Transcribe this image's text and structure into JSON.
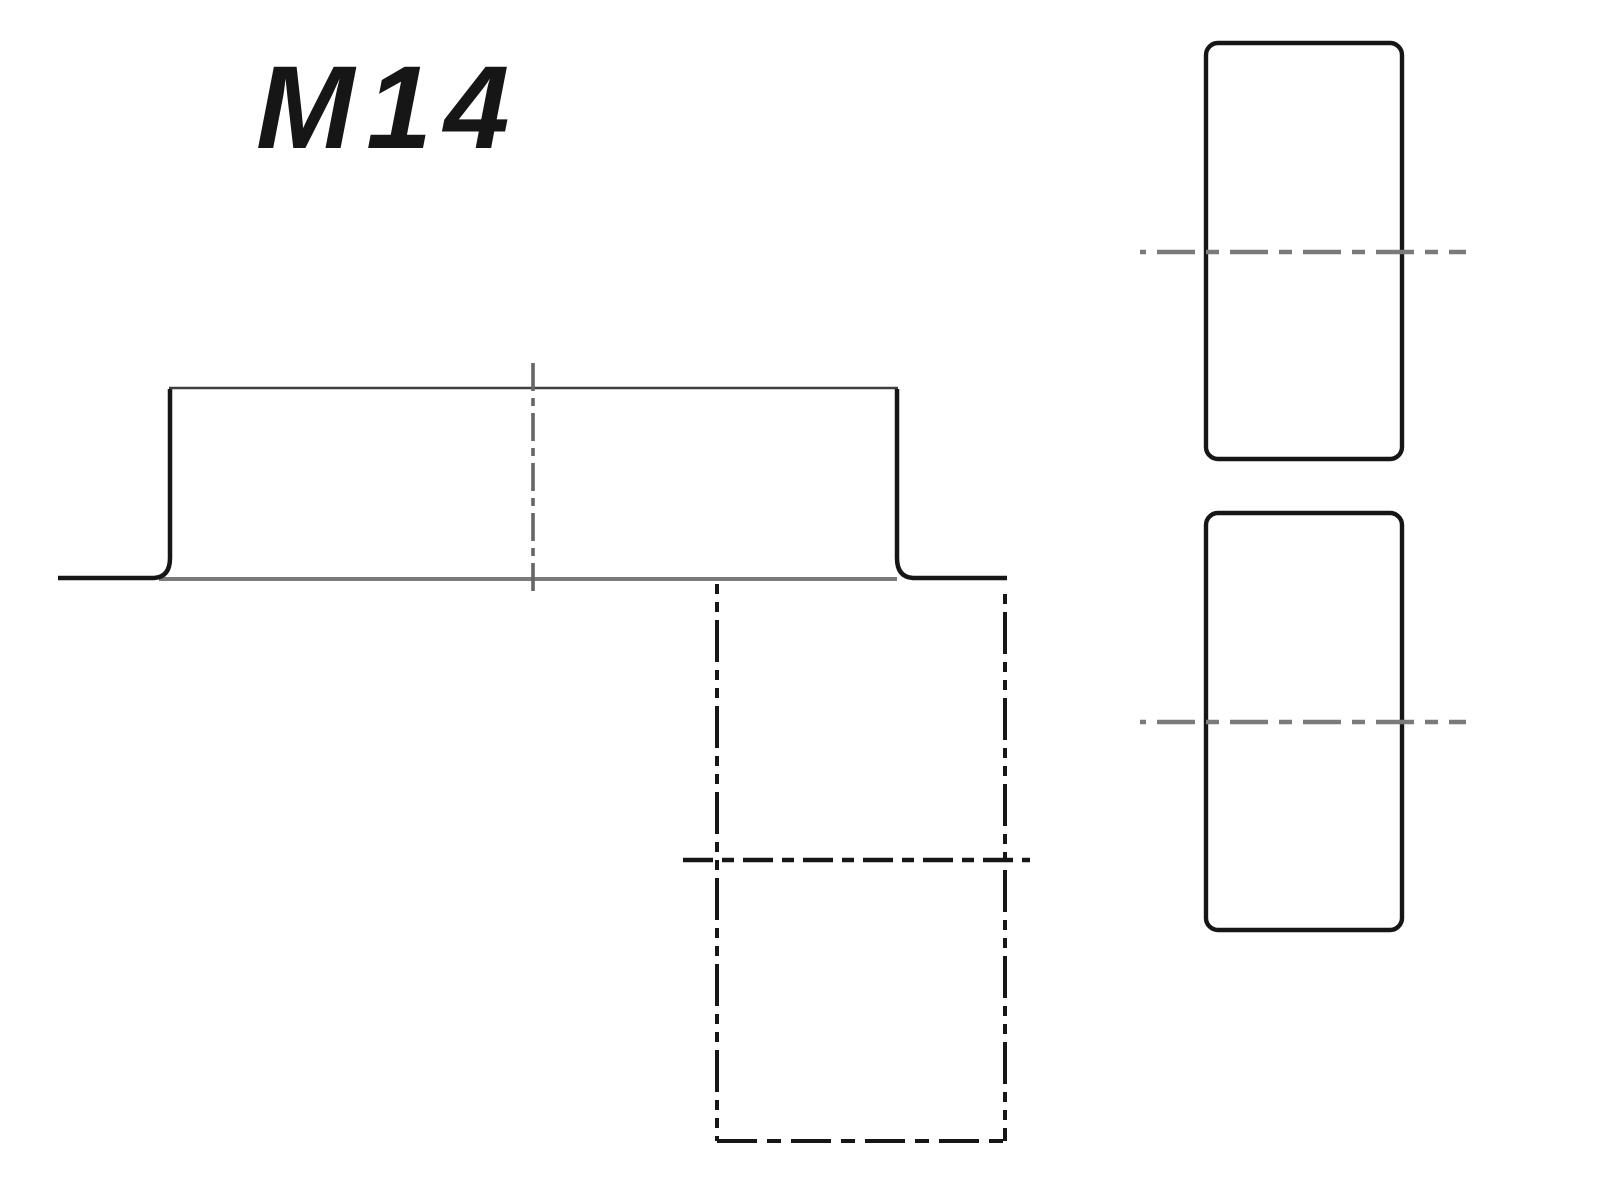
{
  "title": {
    "text": "M14"
  },
  "colors": {
    "background": "#ffffff",
    "text": "#161616",
    "black": "#161616",
    "dark": "#3f3f3f",
    "gray": "#7a7a7a",
    "gray_dark": "#666666"
  },
  "drawing": {
    "canvas": {
      "width": 1597,
      "height": 1200
    },
    "label": {
      "x": 256,
      "y": 148,
      "font_size": 118,
      "letter_spacing": 12
    },
    "elements": [
      {
        "name": "flange-baseline",
        "kind": "line",
        "x1": 159,
        "y1": 579,
        "x2": 897,
        "y2": 579,
        "color": "gray",
        "width": 4,
        "dash": "",
        "offset": 0
      },
      {
        "name": "flange-profile-left-edge",
        "kind": "path",
        "d": "M 58 578 L 154 578 Q 170 577 170 558 L 170 389",
        "color": "black",
        "width": 4.5,
        "dash": "",
        "offset": 0
      },
      {
        "name": "boss-top-edge",
        "kind": "line",
        "x1": 169,
        "y1": 388,
        "x2": 898,
        "y2": 388,
        "color": "dark",
        "width": 2.6,
        "dash": "",
        "offset": 0
      },
      {
        "name": "flange-profile-right-edge",
        "kind": "path",
        "d": "M 897 389 L 897 558 Q 897 577 913 578 L 1007 578",
        "color": "black",
        "width": 4.5,
        "dash": "",
        "offset": 0
      },
      {
        "name": "section-vertical-center-line",
        "kind": "line",
        "x1": 533,
        "y1": 363,
        "x2": 533,
        "y2": 596,
        "color": "gray_dark",
        "width": 3.6,
        "dash": "28 7 8 7",
        "offset": 0
      },
      {
        "name": "hidden-bore-left-edge",
        "kind": "line",
        "x1": 717,
        "y1": 584,
        "x2": 717,
        "y2": 1141,
        "color": "black",
        "width": 4,
        "dash": "42 8 10 8 10 8",
        "offset": 50,
        "linestyle": "phantom"
      },
      {
        "name": "hidden-bore-right-edge",
        "kind": "line",
        "x1": 1005,
        "y1": 586,
        "x2": 1005,
        "y2": 1141,
        "color": "black",
        "width": 4,
        "dash": "42 8 10 8 10 8",
        "offset": 60,
        "linestyle": "phantom"
      },
      {
        "name": "hidden-bore-bottom-edge",
        "kind": "line",
        "x1": 717,
        "y1": 1141,
        "x2": 1005,
        "y2": 1141,
        "color": "black",
        "width": 4,
        "dash": "40 10 14 10",
        "offset": 0,
        "linestyle": "hidden"
      },
      {
        "name": "bore-horizontal-center-line",
        "kind": "line",
        "x1": 683,
        "y1": 860,
        "x2": 1030,
        "y2": 860,
        "color": "black",
        "width": 4.4,
        "dash": "30 9 12 9",
        "offset": 0,
        "linestyle": "center"
      },
      {
        "name": "side-view-upper-outline",
        "kind": "rect",
        "x": 1206,
        "y": 43,
        "w": 196,
        "h": 416,
        "rx": 12,
        "color": "black",
        "width": 4.4,
        "dash": "",
        "offset": 0
      },
      {
        "name": "side-view-upper-center-line",
        "kind": "line",
        "x1": 1140,
        "y1": 252,
        "x2": 1466,
        "y2": 252,
        "color": "gray",
        "width": 4.6,
        "dash": "38 11 13 11",
        "offset": 56,
        "linestyle": "center"
      },
      {
        "name": "side-view-lower-outline",
        "kind": "rect",
        "x": 1206,
        "y": 513,
        "w": 196,
        "h": 417,
        "rx": 12,
        "color": "black",
        "width": 4.4,
        "dash": "",
        "offset": 0
      },
      {
        "name": "side-view-lower-center-line",
        "kind": "line",
        "x1": 1140,
        "y1": 722,
        "x2": 1466,
        "y2": 722,
        "color": "gray",
        "width": 4.6,
        "dash": "38 11 13 11",
        "offset": 56,
        "linestyle": "center"
      }
    ]
  }
}
